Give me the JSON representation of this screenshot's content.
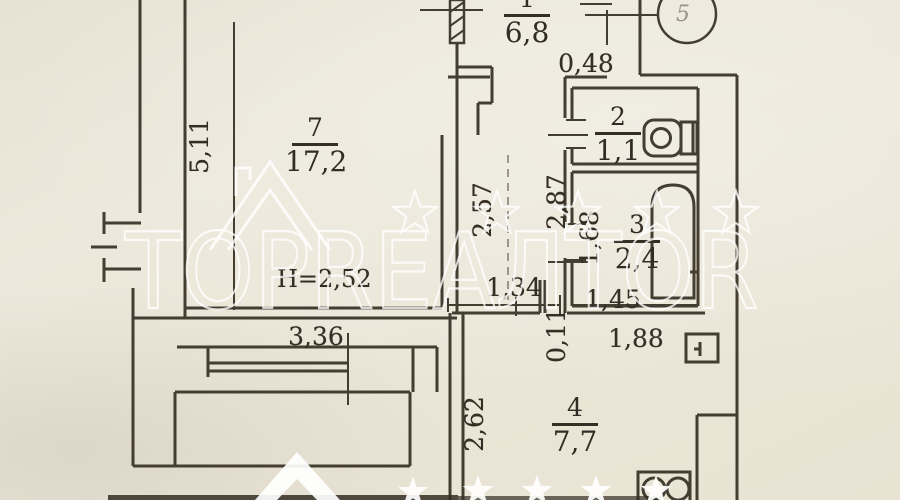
{
  "watermark": {
    "brand": "TOPREАЛTOR"
  },
  "rooms": {
    "hall": {
      "number": "1",
      "area": "6,8"
    },
    "wc": {
      "number": "2",
      "area": "1,1"
    },
    "bath": {
      "number": "3",
      "area": "2,4"
    },
    "kitchen": {
      "number": "4",
      "area": "7,7"
    },
    "balcony_top": {
      "number": "5"
    },
    "living": {
      "number": "7",
      "area": "17,2"
    }
  },
  "dims": {
    "hall_pier": "0,48",
    "living_length": "5,11",
    "living_width": "3,36",
    "ceiling_height": "H=2,52",
    "corridor_length": "2,57",
    "bath_outer_wall": "2,87",
    "corridor_width": "1,34",
    "bath_length": "1,68",
    "bath_width": "1,45",
    "wall_thickness": "0,11",
    "kitchen_wall": "1,88",
    "kitchen_length": "2,62"
  }
}
